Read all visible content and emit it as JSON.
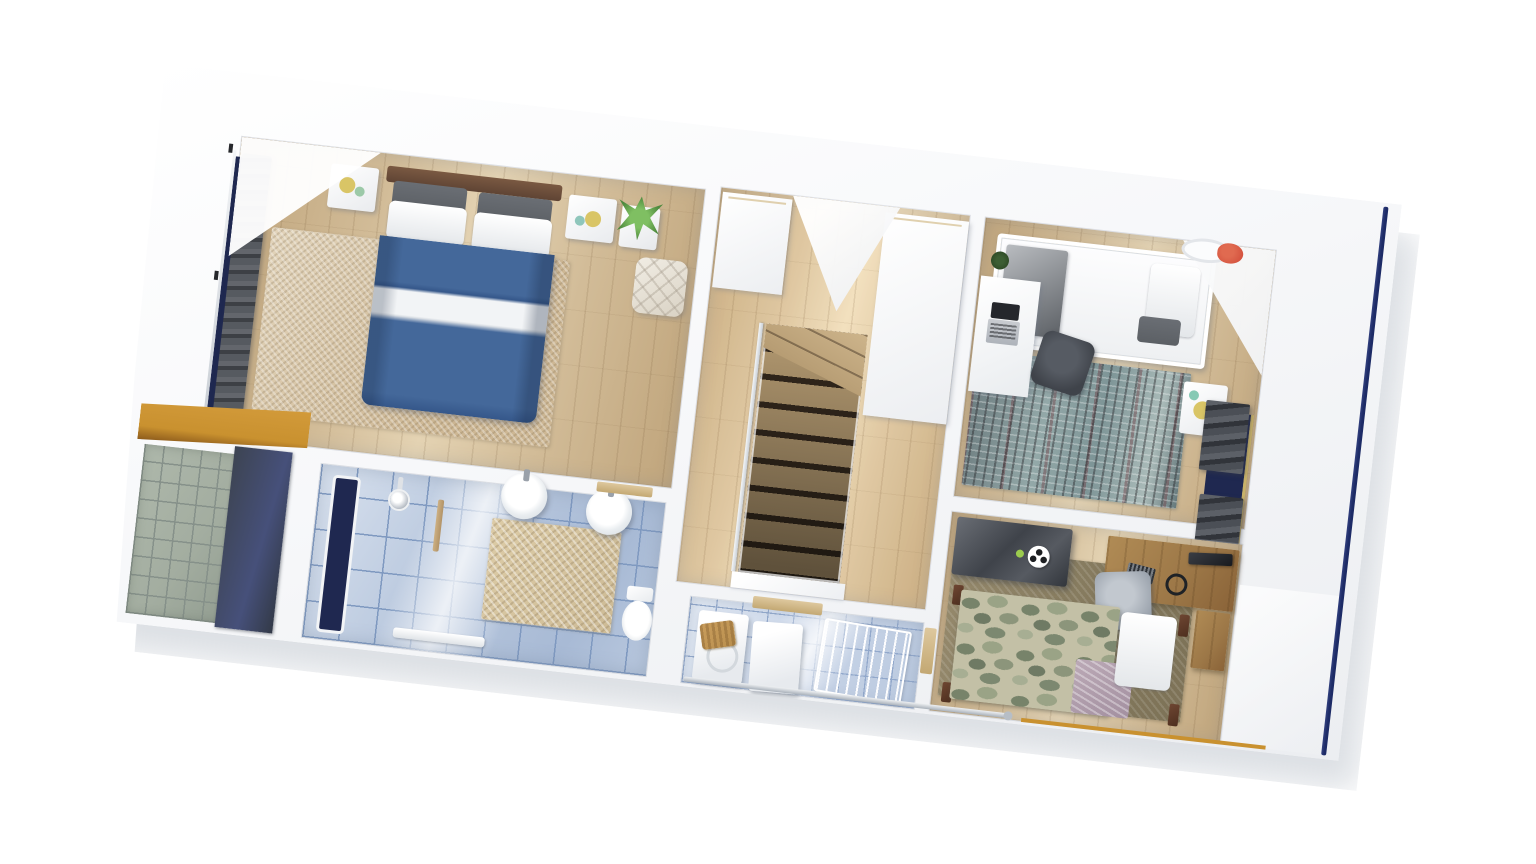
{
  "scene": {
    "type": "3d-floorplan-cutaway-render",
    "floor": "upper-floor",
    "view": "top-down dollhouse, rotated slightly clockwise",
    "visible_text": ""
  },
  "palette": {
    "page-bg": "#ffffff",
    "shell-a": "#f7f8fa",
    "shell-b": "#eceef1",
    "wall-shade": "#eef0f3",
    "shadow-grey": "#b9c0c9",
    "wood": "#d2bc98",
    "wood-light": "#e4d3b3",
    "wood-dark": "#c0a57c",
    "tile": "#b9c8de",
    "tile-grout": "#7f99c0",
    "tile-laundry": "#c9d5e8",
    "tile-laundry-grout": "#92a8cb",
    "duvet": "#44689a",
    "duvet-stripe": "#f2f4f6",
    "headboard": "#5f4434",
    "pillow-grey": "#5c6065",
    "rug-beige-a": "#e2d4bb",
    "rug-beige-b": "#cdb794",
    "rug-teal-a": "#6d7d80",
    "rug-teal-b": "#93a8a8",
    "rug-olive-a": "#95896c",
    "rug-olive-b": "#857a5e",
    "camo-base": "#c3c0a6",
    "curtain-a": "#63666c",
    "curtain-b": "#565a60",
    "window-navy": "#1f2850",
    "fascia-navy": "#1d2b66",
    "balcony-stone": "#a3ada0",
    "balcony-grout": "#86918a",
    "balcony-mat": "#46507a",
    "roof-wood-a": "#d29a3a",
    "roof-wood-b": "#c9912f",
    "stair-wood": "#b59b72",
    "stair-gap": "#33281d",
    "desk-brown": "#9c7747",
    "chair-dark": "#3f434a",
    "chair-grey": "#9aa2ac",
    "laptop-grey": "#c9ccd1",
    "screen-dark": "#25272c",
    "light-red": "#d4523e",
    "plant-green": "#4f8a3e",
    "accent-yellow": "#d9c566",
    "mat-beige": "#dccba6",
    "basket-tan": "#c99d5c"
  },
  "rooms": [
    {
      "id": "master-bedroom",
      "floor": "wood",
      "furniture": [
        "double-bed-blue-duvet",
        "wood-headboard",
        "nightstand-left",
        "nightstand-right",
        "shag-beige-rug",
        "aloe-plant-stand",
        "cream-armchair",
        "full-wall-window-with-grey-curtains"
      ]
    },
    {
      "id": "landing-hallway",
      "floor": "wood",
      "furniture": [
        "staircase-down",
        "winder-steps",
        "glass-railing",
        "built-in-cabinet",
        "tall-wardrobe"
      ]
    },
    {
      "id": "bathroom",
      "floor": "blue-tile",
      "furniture": [
        "tall-navy-window",
        "shower-head",
        "wood-towel-handle",
        "round-sink-left",
        "round-sink-right",
        "beige-bath-mat",
        "toilet",
        "towel-rail"
      ]
    },
    {
      "id": "laundry-room",
      "floor": "blue-tile",
      "furniture": [
        "washing-machine",
        "tumble-dryer",
        "wicker-basket",
        "wire-drying-rack",
        "wood-shelf"
      ]
    },
    {
      "id": "bedroom-2",
      "floor": "wood",
      "furniture": [
        "single-bed-grey-blanket",
        "teal-distressed-rug",
        "white-desk",
        "laptop",
        "dark-office-chair",
        "nightstand-yellow-lamp",
        "window-blinds-east",
        "red-ceiling-light",
        "small-plant"
      ]
    },
    {
      "id": "bedroom-3",
      "floor": "wood",
      "furniture": [
        "single-bed-camo-blanket",
        "olive-rug",
        "wood-gaming-desk",
        "monitor",
        "keyboard",
        "headphones",
        "grey-desk-chair",
        "dark-play-table",
        "soccer-ball",
        "desk-return"
      ]
    }
  ],
  "exterior": {
    "balcony": [
      "stone-tile-deck",
      "navy-mat",
      "orange-wood-roof-edge",
      "white-parapet"
    ],
    "right-edge": "navy-fascia-line",
    "bottom-wall": [
      "silver-window-rail",
      "orange-wood-strip"
    ]
  }
}
